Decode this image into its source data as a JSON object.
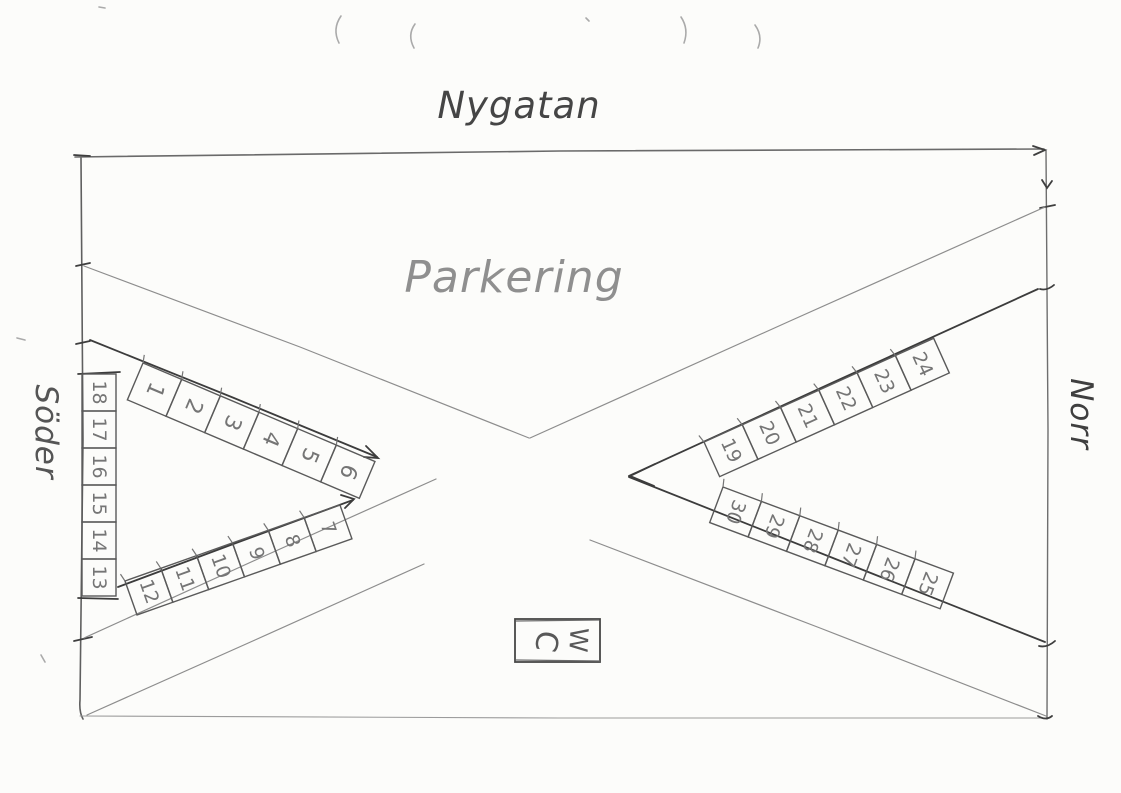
{
  "map": {
    "street_top": "Nygatan",
    "area_label": "Parkering",
    "side_left": "Söder",
    "side_right": "Norr",
    "wc": {
      "label": "WC",
      "letters": [
        "C",
        "W"
      ]
    },
    "rows": [
      {
        "id": "row-1-6",
        "spots": [
          "1",
          "2",
          "3",
          "4",
          "5",
          "6"
        ]
      },
      {
        "id": "row-7-12",
        "spots": [
          "12",
          "11",
          "10",
          "9",
          "8",
          "7"
        ]
      },
      {
        "id": "column-13-18",
        "spots": [
          "18",
          "17",
          "16",
          "15",
          "14",
          "13"
        ]
      },
      {
        "id": "row-19-24",
        "spots": [
          "19",
          "20",
          "21",
          "22",
          "23",
          "24"
        ]
      },
      {
        "id": "row-25-30",
        "spots": [
          "30",
          "29",
          "28",
          "27",
          "26",
          "25"
        ]
      }
    ]
  },
  "colors": {
    "pencil_dark": "#3c3c3c",
    "pencil": "#5a5a5a",
    "pencil_mid": "#757575",
    "pencil_light": "#9a9a9a",
    "area_label": "#8f8f8f",
    "paper": "#fcfcfa"
  }
}
